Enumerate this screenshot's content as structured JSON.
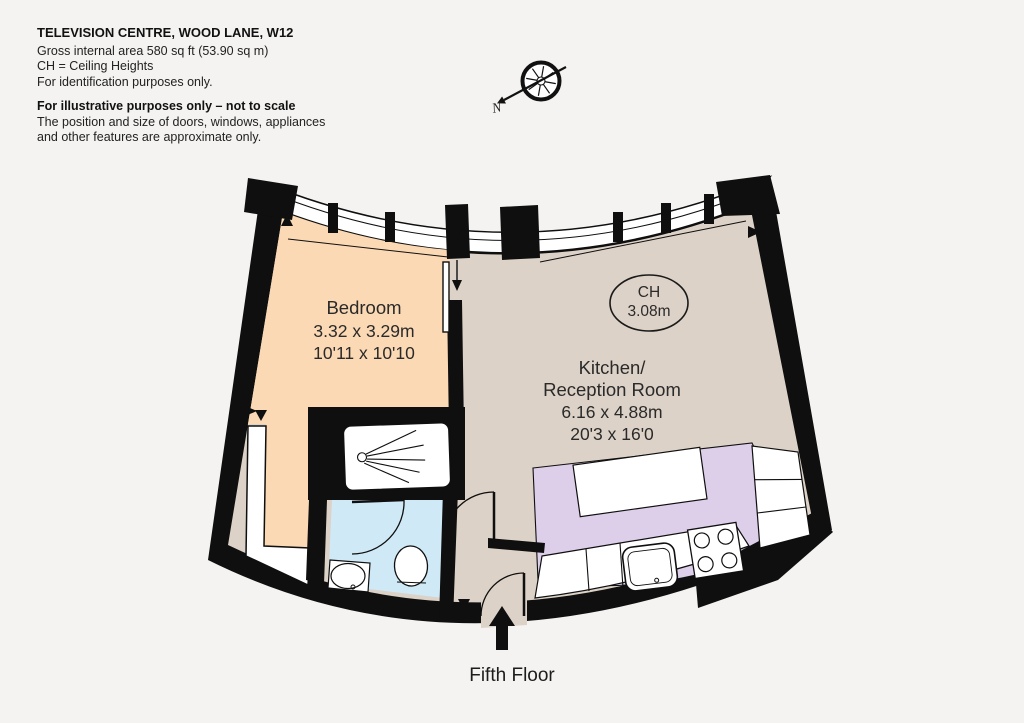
{
  "header": {
    "address": "TELEVISION CENTRE, WOOD LANE, W12",
    "gross_area": "Gross internal area 580 sq ft (53.90 sq m)",
    "ch_note": "CH =  Ceiling Heights",
    "purpose_note": "For identification purposes only.",
    "disclaimer_heading": "For illustrative purposes only – not to scale",
    "disclaimer_line1": "The position and size of doors, windows, appliances",
    "disclaimer_line2": "and other features are approximate  only."
  },
  "compass": {
    "north_label": "N"
  },
  "plan": {
    "rooms": {
      "bedroom": {
        "name": "Bedroom",
        "size_metric": "3.32 x 3.29m",
        "size_imperial": "10'11 x 10'10",
        "fill": "#fbd9b4"
      },
      "kitchen_reception": {
        "name_line1": "Kitchen/",
        "name_line2": "Reception Room",
        "size_metric": "6.16 x 4.88m",
        "size_imperial": "20'3 x 16'0",
        "fill": "#dcd2c7",
        "kitchen_fill": "#ddcfea"
      },
      "bathroom": {
        "fill": "#cfe9f6"
      }
    },
    "ceiling_height_badge": {
      "label": "CH",
      "value": "3.08m"
    }
  },
  "footer": {
    "floor_label": "Fifth Floor"
  },
  "colors": {
    "wall": "#0f0f0f",
    "background": "#f4f3f1"
  }
}
